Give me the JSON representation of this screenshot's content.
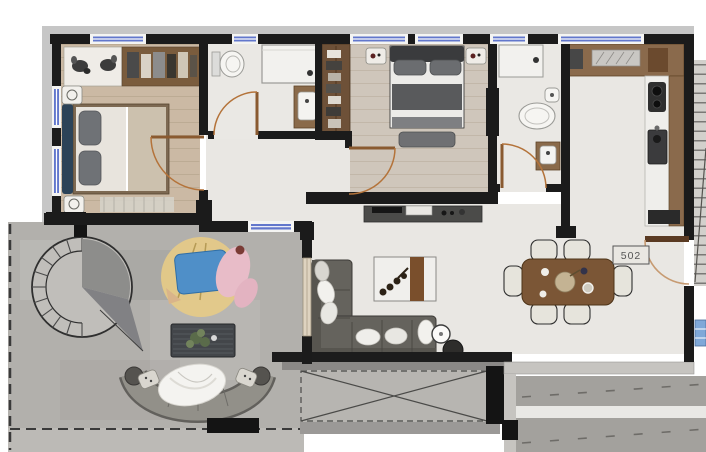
{
  "unit": {
    "label": "502"
  },
  "palette": {
    "wall": "#1b1b1b",
    "wall_outline": "#c6c6c6",
    "window_blue": "#6277cc",
    "door_orange": "#b4733a",
    "wood_floor_bedroom1": "#cbb9a4",
    "wood_floor_bedroom2": "#cfc6bb",
    "marble_floor": "#e9e7e3",
    "terrace_concrete": "#b2b0ac",
    "counter_brown": "#8a6a4c",
    "closet_brown": "#6e5138",
    "dining_table_brown": "#7b5636",
    "sofa_gray": "#65635d",
    "bed_headboard_navy": "#2c4358",
    "bed2_duvet_gray": "#595a5c",
    "rug_yellow": "#e7cb86",
    "blanket_pink": "#e8bcc8",
    "cushion_blue": "#4f8fc8",
    "void_gray": "#b7b5b1"
  }
}
